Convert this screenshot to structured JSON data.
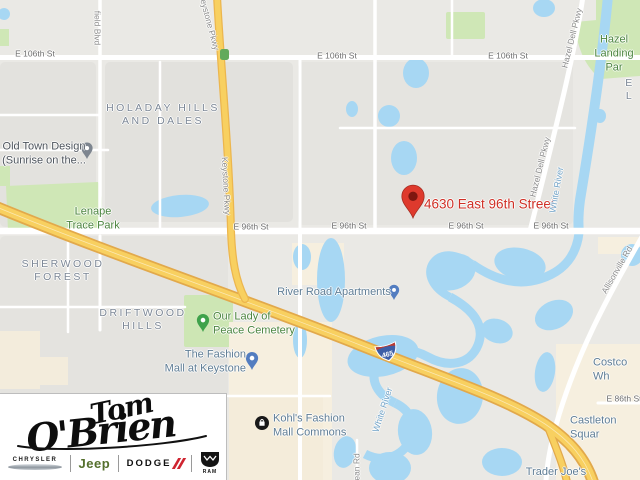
{
  "map": {
    "destination": {
      "address": "4630 East 96th Street"
    },
    "interstate": {
      "shield_number": "465"
    },
    "labels": [
      {
        "name": "street-label-e106-1",
        "cls": "street",
        "text": "E 106th St",
        "x": 35,
        "y": 54
      },
      {
        "name": "street-label-e106-2",
        "cls": "street",
        "text": "E 106th St",
        "x": 337,
        "y": 56
      },
      {
        "name": "street-label-e106-3",
        "cls": "street",
        "text": "E 106th St",
        "x": 508,
        "y": 56
      },
      {
        "name": "street-label-e96-1",
        "cls": "street",
        "text": "E 96th St",
        "x": 251,
        "y": 227
      },
      {
        "name": "street-label-e96-2",
        "cls": "street",
        "text": "E 96th St",
        "x": 349,
        "y": 226
      },
      {
        "name": "street-label-e96-3",
        "cls": "street",
        "text": "E 96th St",
        "x": 466,
        "y": 226
      },
      {
        "name": "street-label-e96-4",
        "cls": "street",
        "text": "E 96th St",
        "x": 551,
        "y": 226
      },
      {
        "name": "street-label-e86",
        "cls": "street",
        "text": "E 86th St",
        "x": 624,
        "y": 399
      },
      {
        "name": "area-label-holaday-hills",
        "cls": "area",
        "text": "HOLADAY HILLS\nAND DALES",
        "x": 163,
        "y": 115
      },
      {
        "name": "area-label-sherwood-forest",
        "cls": "area",
        "text": "SHERWOOD\nFOREST",
        "x": 63,
        "y": 271
      },
      {
        "name": "area-label-driftwood-hills",
        "cls": "area",
        "text": "DRIFTWOOD\nHILLS",
        "x": 143,
        "y": 320
      },
      {
        "name": "area-label-el-partial",
        "cls": "area",
        "text": "E L",
        "x": 630,
        "y": 90
      },
      {
        "name": "poi-label-old-town-design",
        "cls": "poi-dark",
        "text": "Old Town Design\n(Sunrise on the...",
        "x": 44,
        "y": 154
      },
      {
        "name": "poi-label-lenape-trace-park",
        "cls": "poi-green",
        "text": "Lenape\nTrace Park",
        "x": 93,
        "y": 219
      },
      {
        "name": "poi-label-our-lady-of-peace-cemetery",
        "cls": "poi-green",
        "text": "Our Lady of\nPeace Cemetery",
        "x": 213,
        "y": 324,
        "align": "l"
      },
      {
        "name": "poi-label-hazel-landing-park",
        "cls": "poi-green",
        "text": "Hazel\nLanding Par",
        "x": 614,
        "y": 54
      },
      {
        "name": "poi-label-river-road-apartments",
        "cls": "poi-blue",
        "text": "River Road Apartments",
        "x": 334,
        "y": 293
      },
      {
        "name": "poi-label-fashion-mall-at-keystone",
        "cls": "poi-blue",
        "text": "The Fashion\nMall at Keystone",
        "x": 246,
        "y": 362,
        "align": "r"
      },
      {
        "name": "poi-label-kohls-fashion-mall-commons",
        "cls": "poi-blue",
        "text": "Kohl's Fashion\nMall Commons",
        "x": 273,
        "y": 426,
        "align": "l"
      },
      {
        "name": "poi-label-castleton-square",
        "cls": "poi-blue",
        "text": "Castleton Squar",
        "x": 570,
        "y": 428,
        "align": "l"
      },
      {
        "name": "poi-label-costco",
        "cls": "poi-blue",
        "text": "Costco Wh",
        "x": 593,
        "y": 370,
        "align": "l"
      },
      {
        "name": "poi-label-trader-joes",
        "cls": "poi-blue",
        "text": "Trader Joe's",
        "x": 556,
        "y": 473
      },
      {
        "name": "destination-address-label",
        "cls": "address",
        "text": "4630 East 96th Street",
        "x": 424,
        "y": 205,
        "align": "l"
      },
      {
        "name": "road-label-keystone-pkwy-top",
        "cls": "roadlab",
        "text": "Keystone Pkwy",
        "x": 209,
        "y": 22,
        "rot": 75
      },
      {
        "name": "road-label-keystone-pkwy",
        "cls": "roadlab",
        "text": "Keystone Pkwy",
        "x": 226,
        "y": 186,
        "rot": 87
      },
      {
        "name": "road-label-hazel-dell-pkwy-top",
        "cls": "roadlab",
        "text": "Hazel Dell Pkwy",
        "x": 572,
        "y": 38,
        "rot": -76
      },
      {
        "name": "road-label-hazel-dell-pkwy-mid",
        "cls": "roadlab",
        "text": "Hazel Dell Pkwy",
        "x": 540,
        "y": 167,
        "rot": -76
      },
      {
        "name": "road-label-allisonville-rd",
        "cls": "roadlab",
        "text": "Allisonville Rd",
        "x": 617,
        "y": 270,
        "rot": -60
      },
      {
        "name": "road-label-dean-rd",
        "cls": "roadlab",
        "text": "Dean Rd",
        "x": 357,
        "y": 470,
        "rot": -90
      },
      {
        "name": "road-label-field-blvd",
        "cls": "roadlab",
        "text": "field Blvd",
        "x": 97,
        "y": 28,
        "rot": 90
      },
      {
        "name": "water-label-white-river-top",
        "cls": "water-lab",
        "text": "White River",
        "x": 557,
        "y": 190,
        "rot": -80
      },
      {
        "name": "water-label-white-river-bottom",
        "cls": "water-lab",
        "text": "White River",
        "x": 383,
        "y": 410,
        "rot": -72
      }
    ],
    "icons": {
      "destination-pin": "red-teardrop-pin",
      "old-town-pin": "gray-teardrop-pin",
      "cemetery-pin": "green-teardrop-pin",
      "mall-pin": "blue-teardrop-pin",
      "apartments-pin": "blue-teardrop-pin",
      "kohls-marker": "black-circle-store-badge",
      "traffic-signal": "green-rounded-square",
      "interstate-shield": "interstate-465-shield"
    },
    "colors": {
      "land": "#eae9e5",
      "residential": "#e3e2de",
      "commercial": "#f6efdf",
      "park": "#cfe7b6",
      "water": "#a7d7f3",
      "road": "#ffffff",
      "highway": "#f8d060",
      "highway_border": "#e2a94b",
      "marker_red": "#de3a2d",
      "address_text": "#cf2f25",
      "poi_blue": "#5f7d95",
      "poi_green": "#4c8540"
    }
  },
  "logo": {
    "dealer_name_line1": "Tom",
    "dealer_name_line2": "O'Brien",
    "brands": [
      "CHRYSLER",
      "Jeep",
      "DODGE",
      "RAM"
    ],
    "brand_colors": {
      "jeep_green": "#55702d",
      "dodge_red": "#cf2430"
    }
  }
}
